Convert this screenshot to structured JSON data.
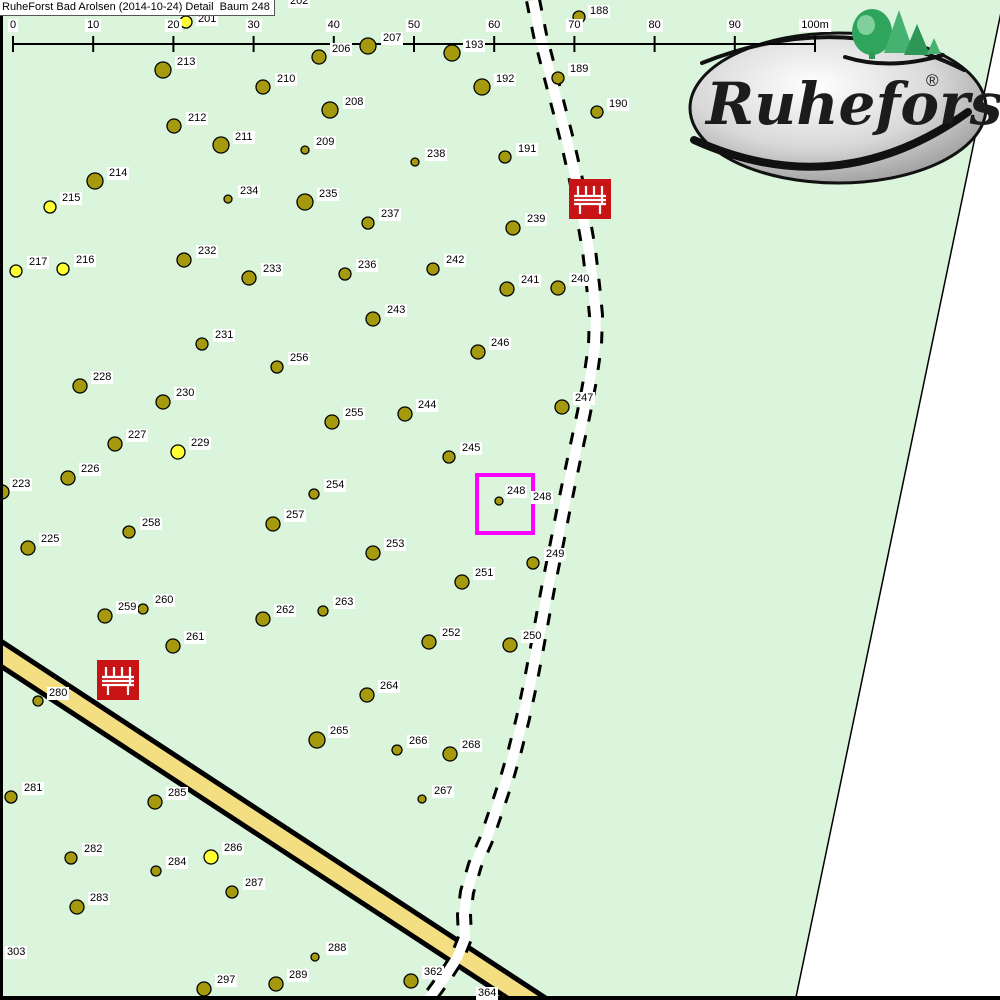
{
  "title": "RuheForst Bad Arolsen (2014-10-24) Detail  Baum 248",
  "scale_bar": {
    "unit_labels": [
      "0",
      "10",
      "20",
      "30",
      "40",
      "50",
      "60",
      "70",
      "80",
      "90",
      "100m"
    ],
    "x0": 13,
    "spacing": 80.2,
    "line_y": 44
  },
  "logo": {
    "name": "Ruheforst",
    "registered_mark": "®"
  },
  "highlight": {
    "tree_number": "248",
    "outside_label": "248",
    "x": 475,
    "y": 473,
    "w": 52,
    "h": 54,
    "color": "#ff00ff"
  },
  "benches": [
    {
      "x": 569,
      "y": 179
    },
    {
      "x": 97,
      "y": 660
    }
  ],
  "colors": {
    "map_green": "#dbf5dc",
    "tree_olive": "#a59a0e",
    "tree_yellow": "#ffff33",
    "road_yellow": "#f3df82",
    "bench_red": "#c81414",
    "highlight_magenta": "#ff00ff"
  },
  "partial_labels": [
    {
      "n": "202",
      "lx": 288,
      "ly": -5
    },
    {
      "n": "303",
      "lx": 5,
      "ly": 946
    }
  ],
  "trees": [
    {
      "n": "188",
      "x": 579,
      "y": 17,
      "r": 6,
      "c": "o",
      "lx": 588,
      "ly": 5
    },
    {
      "n": "201",
      "x": 186,
      "y": 22,
      "r": 6,
      "c": "y",
      "lx": 196,
      "ly": 13
    },
    {
      "n": "206",
      "x": 319,
      "y": 57,
      "r": 7,
      "c": "o",
      "lx": 330,
      "ly": 43
    },
    {
      "n": "207",
      "x": 368,
      "y": 46,
      "r": 8,
      "c": "o",
      "lx": 381,
      "ly": 32
    },
    {
      "n": "193",
      "x": 452,
      "y": 53,
      "r": 8,
      "c": "o",
      "lx": 463,
      "ly": 39
    },
    {
      "n": "213",
      "x": 163,
      "y": 70,
      "r": 8,
      "c": "o",
      "lx": 175,
      "ly": 56
    },
    {
      "n": "210",
      "x": 263,
      "y": 87,
      "r": 7,
      "c": "o",
      "lx": 275,
      "ly": 73
    },
    {
      "n": "189",
      "x": 558,
      "y": 78,
      "r": 6,
      "c": "o",
      "lx": 568,
      "ly": 63
    },
    {
      "n": "212",
      "x": 174,
      "y": 126,
      "r": 7,
      "c": "o",
      "lx": 186,
      "ly": 112
    },
    {
      "n": "208",
      "x": 330,
      "y": 110,
      "r": 8,
      "c": "o",
      "lx": 343,
      "ly": 96
    },
    {
      "n": "190",
      "x": 597,
      "y": 112,
      "r": 6,
      "c": "o",
      "lx": 607,
      "ly": 98
    },
    {
      "n": "211",
      "x": 221,
      "y": 145,
      "r": 8,
      "c": "o",
      "lx": 233,
      "ly": 131
    },
    {
      "n": "209",
      "x": 305,
      "y": 150,
      "r": 4,
      "c": "o",
      "lx": 314,
      "ly": 136
    },
    {
      "n": "238",
      "x": 415,
      "y": 162,
      "r": 4,
      "c": "o",
      "lx": 425,
      "ly": 148
    },
    {
      "n": "191",
      "x": 505,
      "y": 157,
      "r": 6,
      "c": "o",
      "lx": 516,
      "ly": 143
    },
    {
      "n": "192",
      "x": 482,
      "y": 87,
      "r": 8,
      "c": "o",
      "lx": 494,
      "ly": 73
    },
    {
      "n": "214",
      "x": 95,
      "y": 181,
      "r": 8,
      "c": "o",
      "lx": 107,
      "ly": 167
    },
    {
      "n": "234",
      "x": 228,
      "y": 199,
      "r": 4,
      "c": "o",
      "lx": 238,
      "ly": 185
    },
    {
      "n": "235",
      "x": 305,
      "y": 202,
      "r": 8,
      "c": "o",
      "lx": 317,
      "ly": 188
    },
    {
      "n": "215",
      "x": 50,
      "y": 207,
      "r": 6,
      "c": "y",
      "lx": 60,
      "ly": 192
    },
    {
      "n": "237",
      "x": 368,
      "y": 223,
      "r": 6,
      "c": "o",
      "lx": 379,
      "ly": 208
    },
    {
      "n": "239",
      "x": 513,
      "y": 228,
      "r": 7,
      "c": "o",
      "lx": 525,
      "ly": 213
    },
    {
      "n": "217",
      "x": 16,
      "y": 271,
      "r": 6,
      "c": "y",
      "lx": 27,
      "ly": 256
    },
    {
      "n": "216",
      "x": 63,
      "y": 269,
      "r": 6,
      "c": "y",
      "lx": 74,
      "ly": 254
    },
    {
      "n": "232",
      "x": 184,
      "y": 260,
      "r": 7,
      "c": "o",
      "lx": 196,
      "ly": 245
    },
    {
      "n": "233",
      "x": 249,
      "y": 278,
      "r": 7,
      "c": "o",
      "lx": 261,
      "ly": 263
    },
    {
      "n": "236",
      "x": 345,
      "y": 274,
      "r": 6,
      "c": "o",
      "lx": 356,
      "ly": 259
    },
    {
      "n": "242",
      "x": 433,
      "y": 269,
      "r": 6,
      "c": "o",
      "lx": 444,
      "ly": 254
    },
    {
      "n": "241",
      "x": 507,
      "y": 289,
      "r": 7,
      "c": "o",
      "lx": 519,
      "ly": 274
    },
    {
      "n": "240",
      "x": 558,
      "y": 288,
      "r": 7,
      "c": "o",
      "lx": 569,
      "ly": 273
    },
    {
      "n": "243",
      "x": 373,
      "y": 319,
      "r": 7,
      "c": "o",
      "lx": 385,
      "ly": 304
    },
    {
      "n": "231",
      "x": 202,
      "y": 344,
      "r": 6,
      "c": "o",
      "lx": 213,
      "ly": 329
    },
    {
      "n": "256",
      "x": 277,
      "y": 367,
      "r": 6,
      "c": "o",
      "lx": 288,
      "ly": 352
    },
    {
      "n": "246",
      "x": 478,
      "y": 352,
      "r": 7,
      "c": "o",
      "lx": 489,
      "ly": 337
    },
    {
      "n": "228",
      "x": 80,
      "y": 386,
      "r": 7,
      "c": "o",
      "lx": 91,
      "ly": 371
    },
    {
      "n": "230",
      "x": 163,
      "y": 402,
      "r": 7,
      "c": "o",
      "lx": 174,
      "ly": 387
    },
    {
      "n": "247",
      "x": 562,
      "y": 407,
      "r": 7,
      "c": "o",
      "lx": 573,
      "ly": 392
    },
    {
      "n": "244",
      "x": 405,
      "y": 414,
      "r": 7,
      "c": "o",
      "lx": 416,
      "ly": 399
    },
    {
      "n": "255",
      "x": 332,
      "y": 422,
      "r": 7,
      "c": "o",
      "lx": 343,
      "ly": 407
    },
    {
      "n": "227",
      "x": 115,
      "y": 444,
      "r": 7,
      "c": "o",
      "lx": 126,
      "ly": 429
    },
    {
      "n": "229",
      "x": 178,
      "y": 452,
      "r": 7,
      "c": "y",
      "lx": 189,
      "ly": 437
    },
    {
      "n": "226",
      "x": 68,
      "y": 478,
      "r": 7,
      "c": "o",
      "lx": 79,
      "ly": 463
    },
    {
      "n": "223",
      "x": 2,
      "y": 492,
      "r": 7,
      "c": "o",
      "lx": 10,
      "ly": 478
    },
    {
      "n": "245",
      "x": 449,
      "y": 457,
      "r": 6,
      "c": "o",
      "lx": 460,
      "ly": 442
    },
    {
      "n": "248",
      "x": 499,
      "y": 501,
      "r": 4,
      "c": "o",
      "lx": 505,
      "ly": 485
    },
    {
      "n": "254",
      "x": 314,
      "y": 494,
      "r": 5,
      "c": "o",
      "lx": 324,
      "ly": 479
    },
    {
      "n": "257",
      "x": 273,
      "y": 524,
      "r": 7,
      "c": "o",
      "lx": 284,
      "ly": 509
    },
    {
      "n": "258",
      "x": 129,
      "y": 532,
      "r": 6,
      "c": "o",
      "lx": 140,
      "ly": 517
    },
    {
      "n": "225",
      "x": 28,
      "y": 548,
      "r": 7,
      "c": "o",
      "lx": 39,
      "ly": 533
    },
    {
      "n": "249",
      "x": 533,
      "y": 563,
      "r": 6,
      "c": "o",
      "lx": 544,
      "ly": 548
    },
    {
      "n": "253",
      "x": 373,
      "y": 553,
      "r": 7,
      "c": "o",
      "lx": 384,
      "ly": 538
    },
    {
      "n": "251",
      "x": 462,
      "y": 582,
      "r": 7,
      "c": "o",
      "lx": 473,
      "ly": 567
    },
    {
      "n": "259",
      "x": 105,
      "y": 616,
      "r": 7,
      "c": "o",
      "lx": 116,
      "ly": 601
    },
    {
      "n": "260",
      "x": 143,
      "y": 609,
      "r": 5,
      "c": "o",
      "lx": 153,
      "ly": 594
    },
    {
      "n": "262",
      "x": 263,
      "y": 619,
      "r": 7,
      "c": "o",
      "lx": 274,
      "ly": 604
    },
    {
      "n": "263",
      "x": 323,
      "y": 611,
      "r": 5,
      "c": "o",
      "lx": 333,
      "ly": 596
    },
    {
      "n": "261",
      "x": 173,
      "y": 646,
      "r": 7,
      "c": "o",
      "lx": 184,
      "ly": 631
    },
    {
      "n": "252",
      "x": 429,
      "y": 642,
      "r": 7,
      "c": "o",
      "lx": 440,
      "ly": 627
    },
    {
      "n": "250",
      "x": 510,
      "y": 645,
      "r": 7,
      "c": "o",
      "lx": 521,
      "ly": 630
    },
    {
      "n": "280",
      "x": 38,
      "y": 701,
      "r": 5,
      "c": "o",
      "lx": 47,
      "ly": 687
    },
    {
      "n": "264",
      "x": 367,
      "y": 695,
      "r": 7,
      "c": "o",
      "lx": 378,
      "ly": 680
    },
    {
      "n": "265",
      "x": 317,
      "y": 740,
      "r": 8,
      "c": "o",
      "lx": 328,
      "ly": 725
    },
    {
      "n": "266",
      "x": 397,
      "y": 750,
      "r": 5,
      "c": "o",
      "lx": 407,
      "ly": 735
    },
    {
      "n": "268",
      "x": 450,
      "y": 754,
      "r": 7,
      "c": "o",
      "lx": 460,
      "ly": 739
    },
    {
      "n": "267",
      "x": 422,
      "y": 799,
      "r": 4,
      "c": "o",
      "lx": 432,
      "ly": 785
    },
    {
      "n": "281",
      "x": 11,
      "y": 797,
      "r": 6,
      "c": "o",
      "lx": 22,
      "ly": 782
    },
    {
      "n": "285",
      "x": 155,
      "y": 802,
      "r": 7,
      "c": "o",
      "lx": 166,
      "ly": 787
    },
    {
      "n": "282",
      "x": 71,
      "y": 858,
      "r": 6,
      "c": "o",
      "lx": 82,
      "ly": 843
    },
    {
      "n": "286",
      "x": 211,
      "y": 857,
      "r": 7,
      "c": "y",
      "lx": 222,
      "ly": 842
    },
    {
      "n": "284",
      "x": 156,
      "y": 871,
      "r": 5,
      "c": "o",
      "lx": 166,
      "ly": 856
    },
    {
      "n": "287",
      "x": 232,
      "y": 892,
      "r": 6,
      "c": "o",
      "lx": 243,
      "ly": 877
    },
    {
      "n": "283",
      "x": 77,
      "y": 907,
      "r": 7,
      "c": "o",
      "lx": 88,
      "ly": 892
    },
    {
      "n": "297",
      "x": 204,
      "y": 989,
      "r": 7,
      "c": "o",
      "lx": 215,
      "ly": 974
    },
    {
      "n": "289",
      "x": 276,
      "y": 984,
      "r": 7,
      "c": "o",
      "lx": 287,
      "ly": 969
    },
    {
      "n": "288",
      "x": 315,
      "y": 957,
      "r": 4,
      "c": "o",
      "lx": 326,
      "ly": 942
    },
    {
      "n": "362",
      "x": 411,
      "y": 981,
      "r": 7,
      "c": "o",
      "lx": 422,
      "ly": 966
    },
    {
      "n": "364",
      "x": 489,
      "y": 999,
      "r": 6,
      "c": "o",
      "lx": 476,
      "ly": 987
    }
  ]
}
